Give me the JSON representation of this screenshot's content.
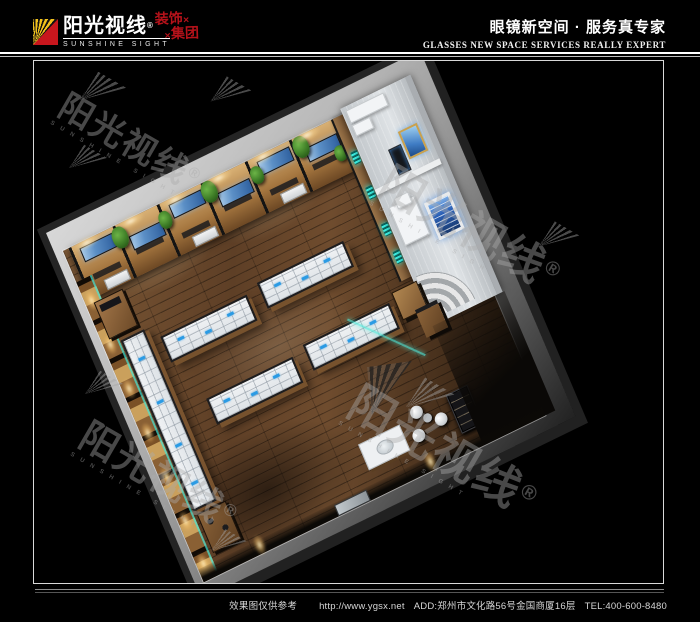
{
  "header": {
    "logo": {
      "cn": "阳光视线",
      "reg": "®",
      "en": "SUNSHINE SIGHT",
      "group_top": "装饰",
      "group_bottom": "集团",
      "group_mark": "✕"
    },
    "slogan_cn": "眼镜新空间 · 服务真专家",
    "slogan_en": "GLASSES NEW SPACE SERVICES REALLY EXPERT"
  },
  "footer": {
    "disclaimer": "效果图仅供参考",
    "url": "http://www.ygsx.net",
    "address": "ADD:郑州市文化路56号金国商厦16层",
    "tel": "TEL:400-600-8480"
  },
  "watermark": {
    "cn": "阳光视线",
    "reg": "®",
    "en": "SUNSHINE SIGHT"
  },
  "colors": {
    "accent_red": "#c8161d",
    "logo_gold": "#f2c21c",
    "cyan_glow": "#35e0d8",
    "poster_blue": "#3f7cc4"
  }
}
